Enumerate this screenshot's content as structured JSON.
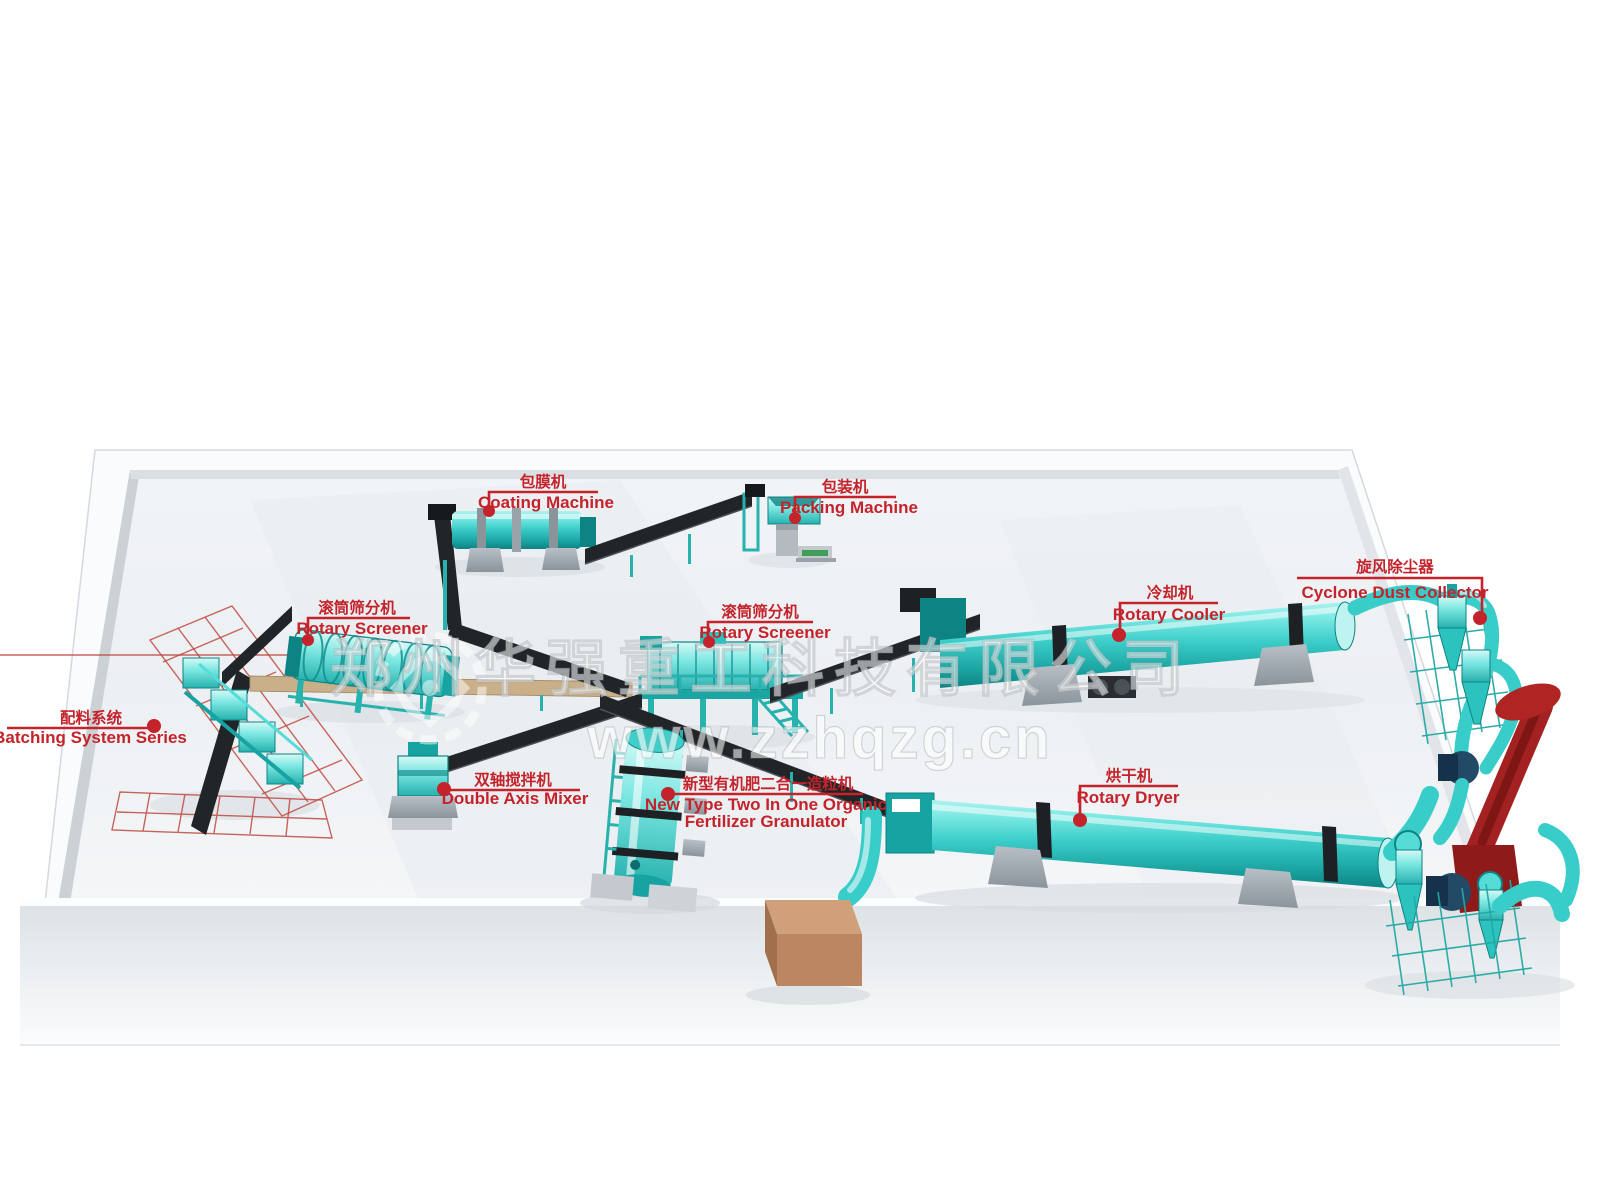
{
  "scene": {
    "title": "Organic fertilizer production line 3D layout",
    "type": "annotated-3d-plant-diagram"
  },
  "watermark": {
    "company": "郑州华强重工科技有限公司",
    "url": "www.zzhqzg.cn",
    "logo": "gear-emblem"
  },
  "labels": [
    {
      "id": "coating-machine",
      "zh": "包膜机",
      "en": "Coating Machine"
    },
    {
      "id": "packing-machine",
      "zh": "包装机",
      "en": "Packing Machine"
    },
    {
      "id": "rotary-screener-1",
      "zh": "滚筒筛分机",
      "en": "Rotary Screener"
    },
    {
      "id": "rotary-screener-2",
      "zh": "滚筒筛分机",
      "en": "Rotary Screener"
    },
    {
      "id": "rotary-cooler",
      "zh": "冷却机",
      "en": "Rotary Cooler"
    },
    {
      "id": "cyclone-dust-collector",
      "zh": "旋风除尘器",
      "en": "Cyclone Dust Collector"
    },
    {
      "id": "batching-system",
      "zh": "配料系统",
      "en": "Batching System Series"
    },
    {
      "id": "double-axis-mixer",
      "zh": "双轴搅拌机",
      "en": "Double Axis Mixer"
    },
    {
      "id": "granulator",
      "zh": "新型有机肥二合一造粒机",
      "en_line1": "New Type Two In One Organic",
      "en_line2": "Fertilizer Granulator"
    },
    {
      "id": "rotary-dryer",
      "zh": "烘干机",
      "en": "Rotary Dryer"
    }
  ],
  "colors": {
    "machine_teal": "#3ecfca",
    "machine_teal_dark": "#0e8384",
    "label_red": "#c4232b",
    "conveyor_black": "#212528",
    "chimney_red": "#a32121",
    "fan_navy": "#224a66",
    "box_brown": "#bc8660",
    "floor_gray": "#eef1f4"
  }
}
